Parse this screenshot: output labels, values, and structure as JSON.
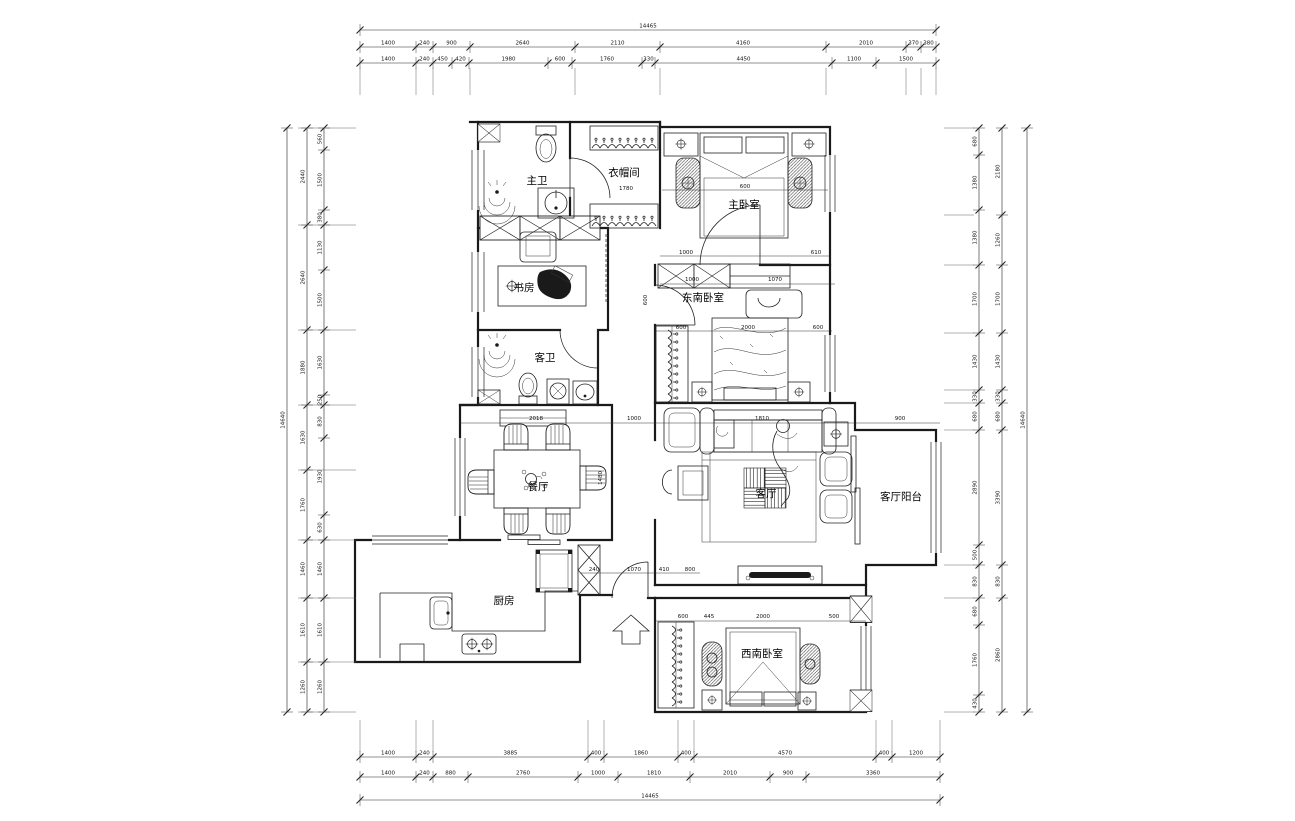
{
  "rooms": {
    "master_bath": "主卫",
    "cloakroom": "衣帽间",
    "master_bedroom": "主卧室",
    "study": "书房",
    "southeast_bedroom": "东南卧室",
    "guest_bath": "客卫",
    "dining_room": "餐厅",
    "living_room": "客厅",
    "living_balcony": "客厅阳台",
    "kitchen": "厨房",
    "southwest_bedroom": "西南卧室"
  },
  "dimensions": {
    "top": {
      "overall": "14465",
      "tier1": [
        "1400",
        "240",
        "900",
        "2640",
        "2110",
        "4160",
        "2010",
        "370",
        "380"
      ],
      "tier2": [
        "1400",
        "240",
        "450",
        "420",
        "1980",
        "600",
        "1760",
        "330",
        "4450",
        "1100",
        "1500"
      ]
    },
    "bottom": {
      "overall": "14465",
      "tier1": [
        "1400",
        "240",
        "3885",
        "400",
        "1860",
        "400",
        "4570",
        "400",
        "1200"
      ],
      "tier2": [
        "1400",
        "240",
        "880",
        "2760",
        "1000",
        "1810",
        "2010",
        "900",
        "3360"
      ]
    },
    "left": {
      "overall": "14640",
      "tier1": [
        "2440",
        "2640",
        "1880",
        "1630",
        "1760",
        "1460",
        "1610",
        "1260"
      ],
      "tier2": [
        "560",
        "1500",
        "380",
        "1130",
        "1500",
        "1630",
        "250",
        "830",
        "1930",
        "630",
        "1460",
        "1610",
        "1260"
      ]
    },
    "right": {
      "overall": "14640",
      "tier1": [
        "2180",
        "1260",
        "1700",
        "1430",
        "330",
        "680",
        "3390",
        "830",
        "2860"
      ],
      "tier2": [
        "680",
        "1380",
        "1380",
        "1700",
        "1430",
        "330",
        "680",
        "2890",
        "500",
        "830",
        "680",
        "1760",
        "430"
      ]
    }
  },
  "dims_inner": {
    "d1": "600",
    "d2": "1000",
    "d3": "610",
    "d4": "1000",
    "d5": "1070",
    "d6": "600",
    "d7": "2000",
    "d8": "600",
    "d9": "600",
    "d10": "2018",
    "d11": "1000",
    "d12": "1480",
    "d13": "1810",
    "d14": "900",
    "d15": "600",
    "d16": "445",
    "d17": "2000",
    "d18": "500",
    "d19": "240",
    "d20": "1070",
    "d21": "410",
    "d22": "800",
    "d23": "1780"
  }
}
